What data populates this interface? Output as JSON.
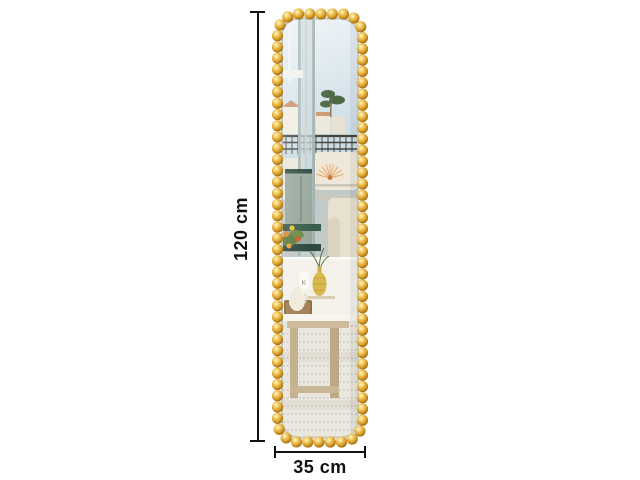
{
  "annotations": {
    "height_label": "120 cm",
    "width_label": "35 cm"
  },
  "colors": {
    "background": "#ffffff",
    "dimension_line": "#111111",
    "frame_gold": "#d89f2b",
    "frame_gold_highlight": "#fff6d8",
    "frame_gold_shadow": "#8a5a0c"
  }
}
